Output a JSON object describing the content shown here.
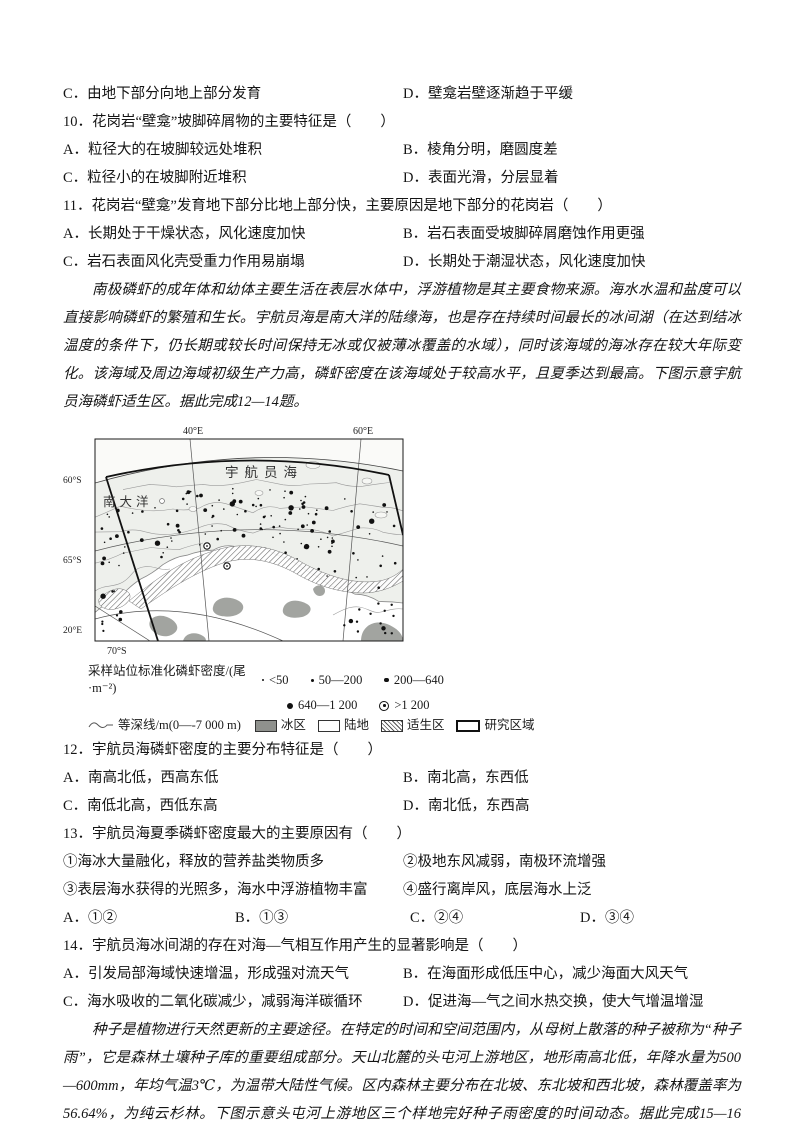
{
  "q9_partial": {
    "option_c": "C．由地下部分向地上部分发育",
    "option_d": "D．壁龛岩壁逐渐趋于平缓"
  },
  "q10": {
    "stem": "10．花岗岩“壁龛”坡脚碎屑物的主要特征是（　　）",
    "options": [
      "A．粒径大的在坡脚较远处堆积",
      "B．棱角分明，磨圆度差",
      "C．粒径小的在坡脚附近堆积",
      "D．表面光滑，分层显着"
    ]
  },
  "q11": {
    "stem": "11．花岗岩“壁龛”发育地下部分比地上部分快，主要原因是地下部分的花岗岩（　　）",
    "options": [
      "A．长期处于干燥状态，风化速度加快",
      "B．岩石表面受坡脚碎屑磨蚀作用更强",
      "C．岩石表面风化壳受重力作用易崩塌",
      "D．长期处于潮湿状态，风化速度加快"
    ]
  },
  "passage1": "南极磷虾的成年体和幼体主要生活在表层水体中，浮游植物是其主要食物来源。海水水温和盐度可以直接影响磷虾的繁殖和生长。宇航员海是南大洋的陆缘海，也是存在持续时间最长的冰间湖（在达到结冰温度的条件下，仍长期或较长时间保持无冰或仅被薄冰覆盖的水域），同时该海域的海冰存在较大年际变化。该海域及周边海域初级生产力高，磷虾密度在该海域处于较高水平，且夏季达到最高。下图示意宇航员海磷虾适生区。据此完成12—14题。",
  "figure": {
    "sea_label": "宇航员海",
    "ocean_label": "南大洋",
    "lon_40": "40°E",
    "lon_60": "60°E",
    "lat_60": "60°S",
    "lat_65": "65°S",
    "corner_lon": "20°E",
    "bottom_lat": "70°S",
    "legend": {
      "density_label": "采样站位标准化磷虾密度/(尾·m⁻²)",
      "class1": "<50",
      "class2": "50—200",
      "class3": "200—640",
      "class4": "640—1 200",
      "class5": ">1 200",
      "isobath": "等深线/m(0—-7 000 m)",
      "ice": "冰区",
      "land": "陆地",
      "suitable": "适生区",
      "study_area": "研究区域"
    }
  },
  "q12": {
    "stem": "12．宇航员海磷虾密度的主要分布特征是（　　）",
    "options": [
      "A．南高北低，西高东低",
      "B．南北高，东西低",
      "C．南低北高，西低东高",
      "D．南北低，东西高"
    ]
  },
  "q13": {
    "stem": "13．宇航员海夏季磷虾密度最大的主要原因有（　　）",
    "items": [
      "①海冰大量融化，释放的营养盐类物质多",
      "②极地东风减弱，南极环流增强",
      "③表层海水获得的光照多，海水中浮游植物丰富",
      "④盛行离岸风，底层海水上泛"
    ],
    "answers": [
      "A．①②",
      "B．①③",
      "C．②④",
      "D．③④"
    ]
  },
  "q14": {
    "stem": "14．宇航员海冰间湖的存在对海—气相互作用产生的显著影响是（　　）",
    "options": [
      "A．引发局部海域快速增温，形成强对流天气",
      "B．在海面形成低压中心，减少海面大风天气",
      "C．海水吸收的二氧化碳减少，减弱海洋碳循环",
      "D．促进海—气之间水热交换，使大气增温增湿"
    ]
  },
  "passage2": "种子是植物进行天然更新的主要途径。在特定的时间和空间范围内，从母树上散落的种子被称为“种子雨”，它是森林土壤种子库的重要组成部分。天山北麓的头屯河上游地区，地形南高北低，年降水量为500—600mm，年均气温3℃，为温带大陆性气候。区内森林主要分布在北坡、东北坡和西北坡，森林覆盖率为56.64%，为纯云杉林。下图示意头屯河上游地区三个样地完好种子雨密度的时间动态。据此完成15—16题。"
}
